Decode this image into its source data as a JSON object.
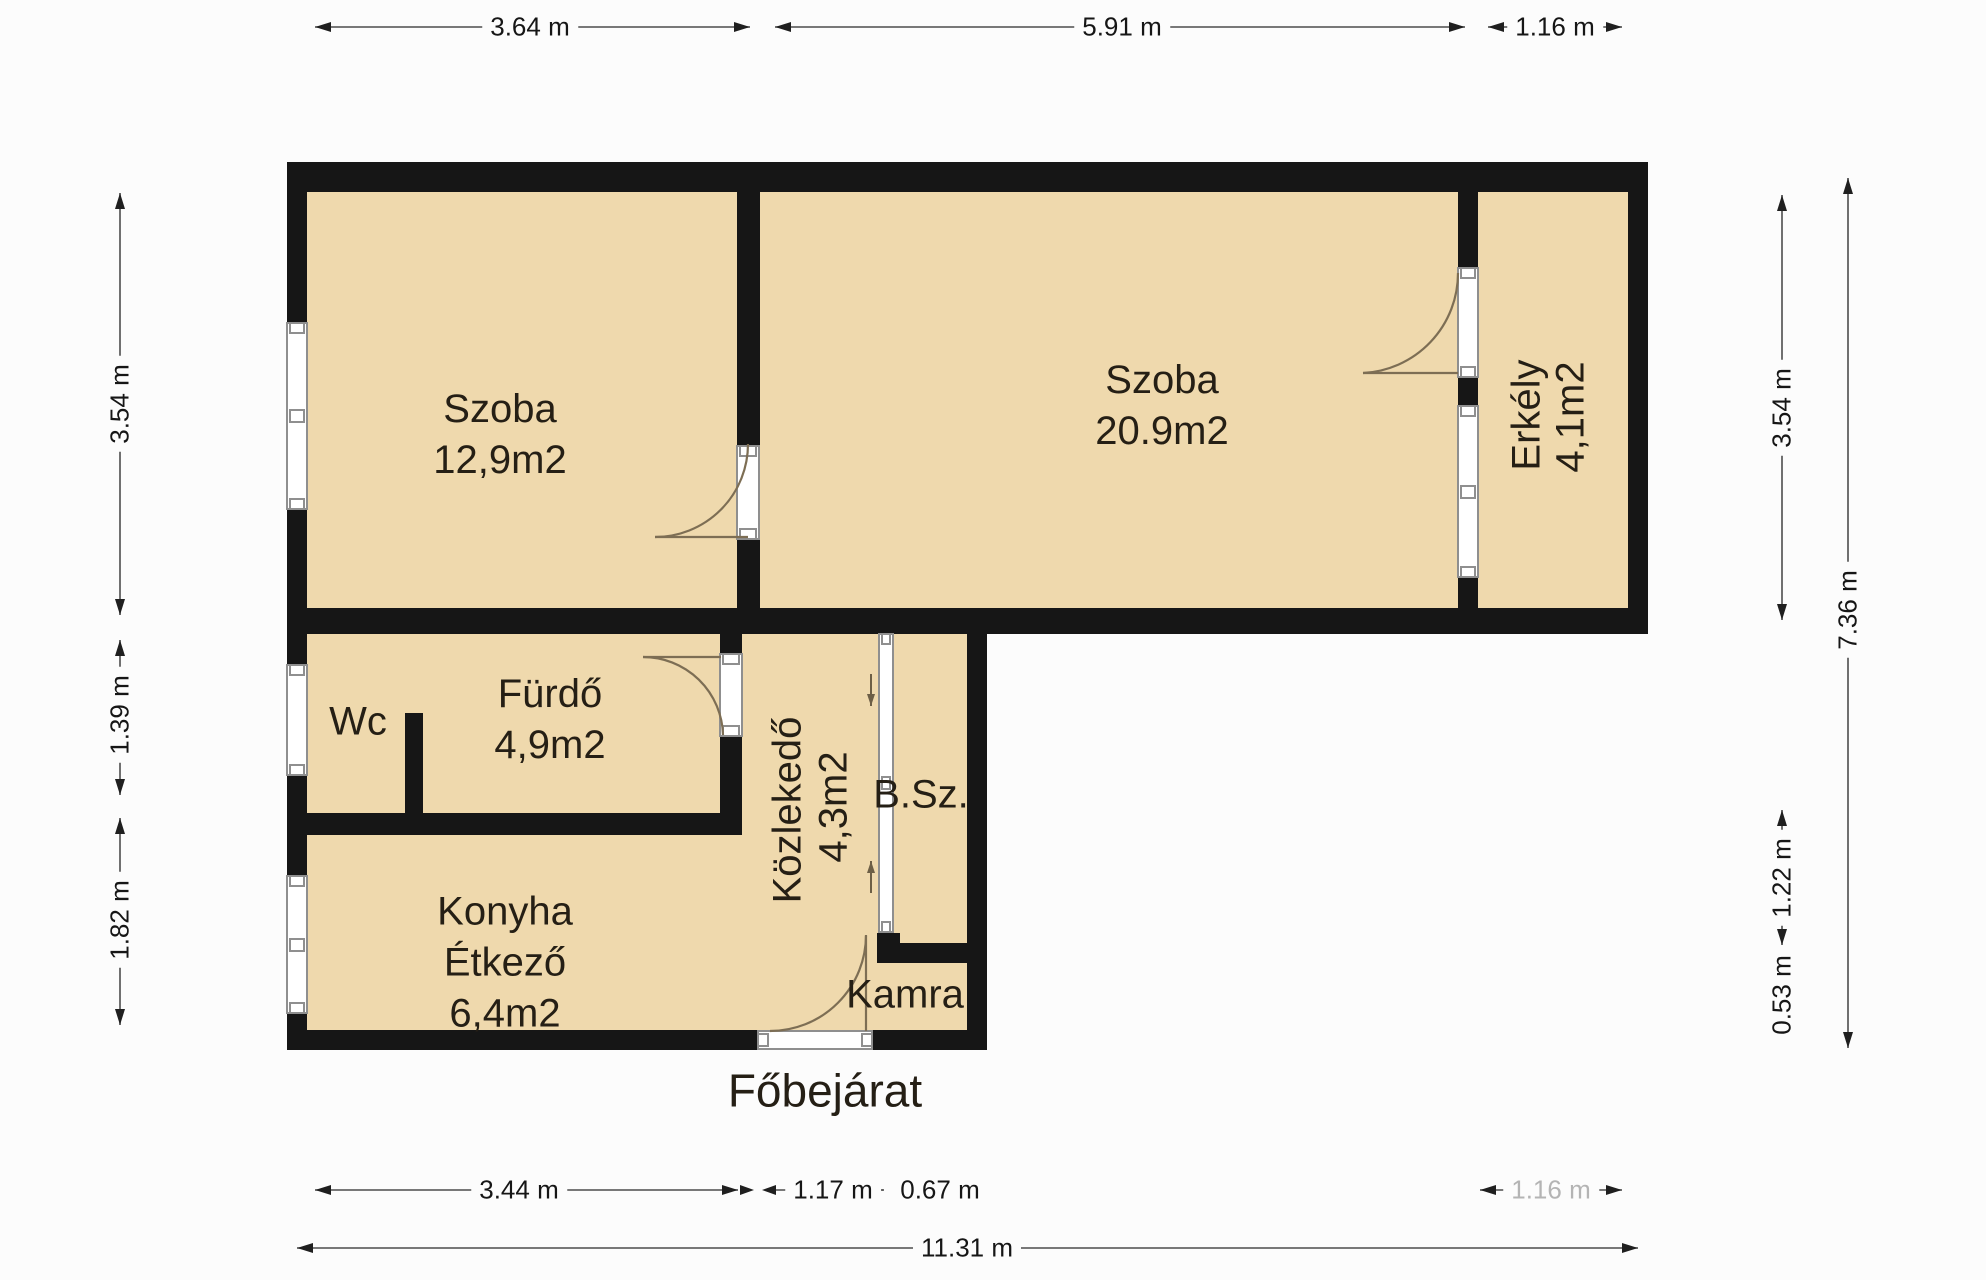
{
  "dims": {
    "top": [
      "3.64 m",
      "5.91 m",
      "1.16 m"
    ],
    "left": [
      "3.54 m",
      "1.39 m",
      "1.82 m"
    ],
    "right": [
      "3.54 m",
      "7.36 m",
      "1.22 m",
      "0.53 m"
    ],
    "bottom": [
      "3.44 m",
      "1.17 m",
      "0.67 m",
      "1.16 m"
    ],
    "total": "11.31 m"
  },
  "rooms": {
    "szoba1": {
      "name": "Szoba",
      "area": "12,9m2"
    },
    "szoba2": {
      "name": "Szoba",
      "area": "20.9m2"
    },
    "erkely": {
      "name": "Erkély",
      "area": "4,1m2"
    },
    "wc": {
      "name": "Wc"
    },
    "furdo": {
      "name": "Fürdő",
      "area": "4,9m2"
    },
    "kozlekedo": {
      "name": "Közlekedő",
      "area": "4,3m2"
    },
    "bsz": {
      "name": "B.Sz."
    },
    "konyha": {
      "name": "Konyha",
      "name2": "Étkező",
      "area": "6,4m2"
    },
    "kamra": {
      "name": "Kamra"
    }
  },
  "entrance_label": "Főbejárat",
  "colors": {
    "floor": "#efd9ad",
    "wall": "#161616",
    "dim_line": "#4d4d4d",
    "faded_dim_text": "#b4b4b4",
    "door_arc": "#7d6e54"
  }
}
